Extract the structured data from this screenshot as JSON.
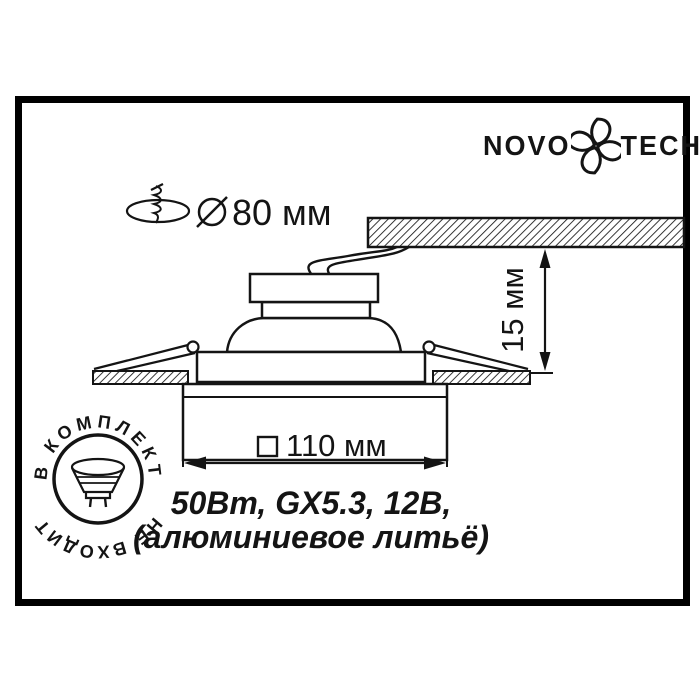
{
  "page": {
    "background": "#ffffff",
    "ink": "#141414"
  },
  "brand": {
    "name_left": "NOVO",
    "name_right": "TECH",
    "icon": "novotech-petal-pinwheel"
  },
  "dimensions": {
    "cutout": {
      "icon": "screw-through-mounting-hole",
      "symbol": "⌀",
      "value": "80 мм"
    },
    "protrusion": {
      "value": "15 мм"
    },
    "trim": {
      "symbol": "□",
      "value": "110 мм"
    }
  },
  "specs": {
    "line1": "50Вт, GX5.3, 12В,",
    "line2": "(алюминиевое литьё)"
  },
  "badge": {
    "icon": "mr16-halogen-lamp",
    "arc_top": "В КОМПЛЕКТ",
    "arc_bottom": "НЕ ВХОДИТ"
  }
}
